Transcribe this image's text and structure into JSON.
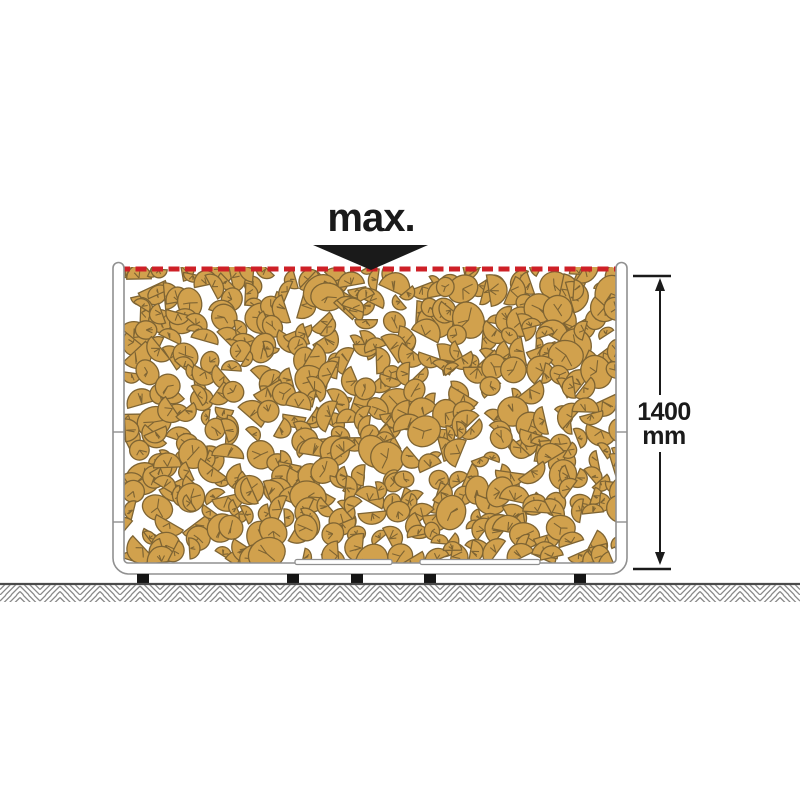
{
  "title": "Firewood rack maximum fill height diagram",
  "annotations": {
    "max_label": "max.",
    "dimension_value": "1400",
    "dimension_unit": "mm"
  },
  "colors": {
    "background": "#ffffff",
    "ink": "#1a1a1a",
    "max_line_red": "#ce2027",
    "wood_fill": "#d1a14d",
    "wood_outline": "#7e6433",
    "frame_fill": "#ffffff",
    "frame_stroke": "#909090",
    "ground_line": "#4a4a4a",
    "ground_hatch": "#8a8a8a",
    "feet": "#151515"
  },
  "wood_pile": {
    "seed": 12,
    "cell": 20,
    "extra_prob": 0.38,
    "r_min": 8,
    "r_max": 16,
    "area": {
      "x": 124,
      "y": 266,
      "w": 492,
      "h": 298
    }
  }
}
